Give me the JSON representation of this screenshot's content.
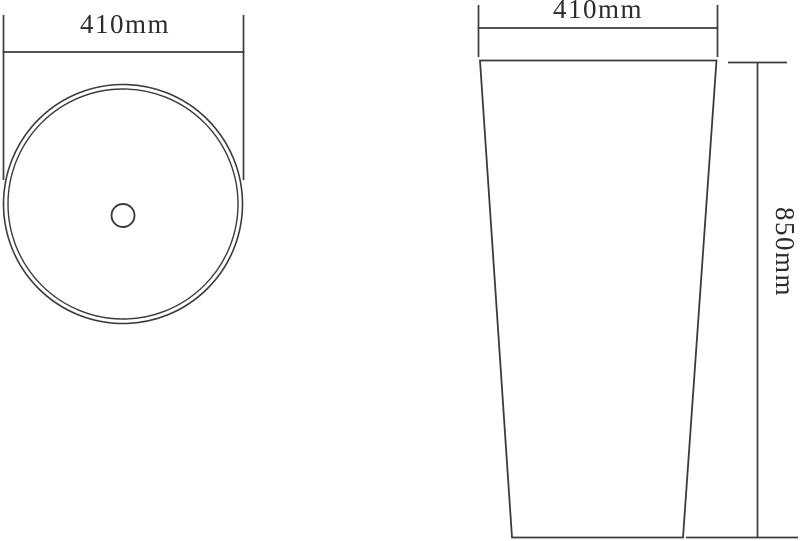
{
  "drawing": {
    "views": {
      "top": {
        "diameter_label": "410mm"
      },
      "front": {
        "width_label": "410mm",
        "height_label": "850mm"
      }
    },
    "colors": {
      "line": "#3b3b3b",
      "text": "#2c2c2c",
      "background": "#ffffff"
    }
  }
}
